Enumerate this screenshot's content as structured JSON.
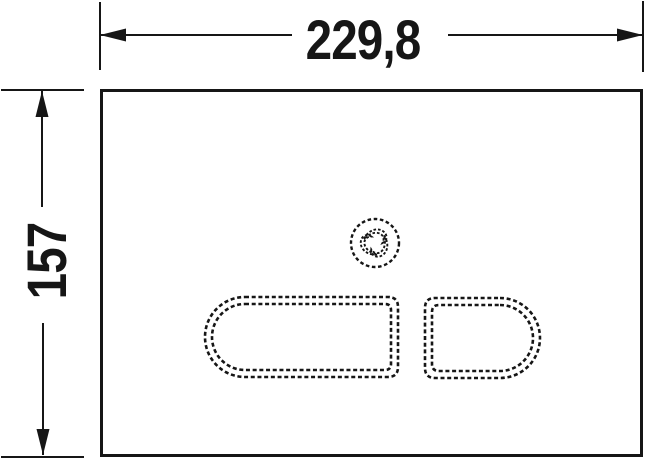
{
  "colors": {
    "line": "#161616",
    "background": "#ffffff"
  },
  "drawing": {
    "width_label": "229,8",
    "height_label": "157"
  },
  "icons": {
    "center_symbol": "swirl-icon"
  }
}
